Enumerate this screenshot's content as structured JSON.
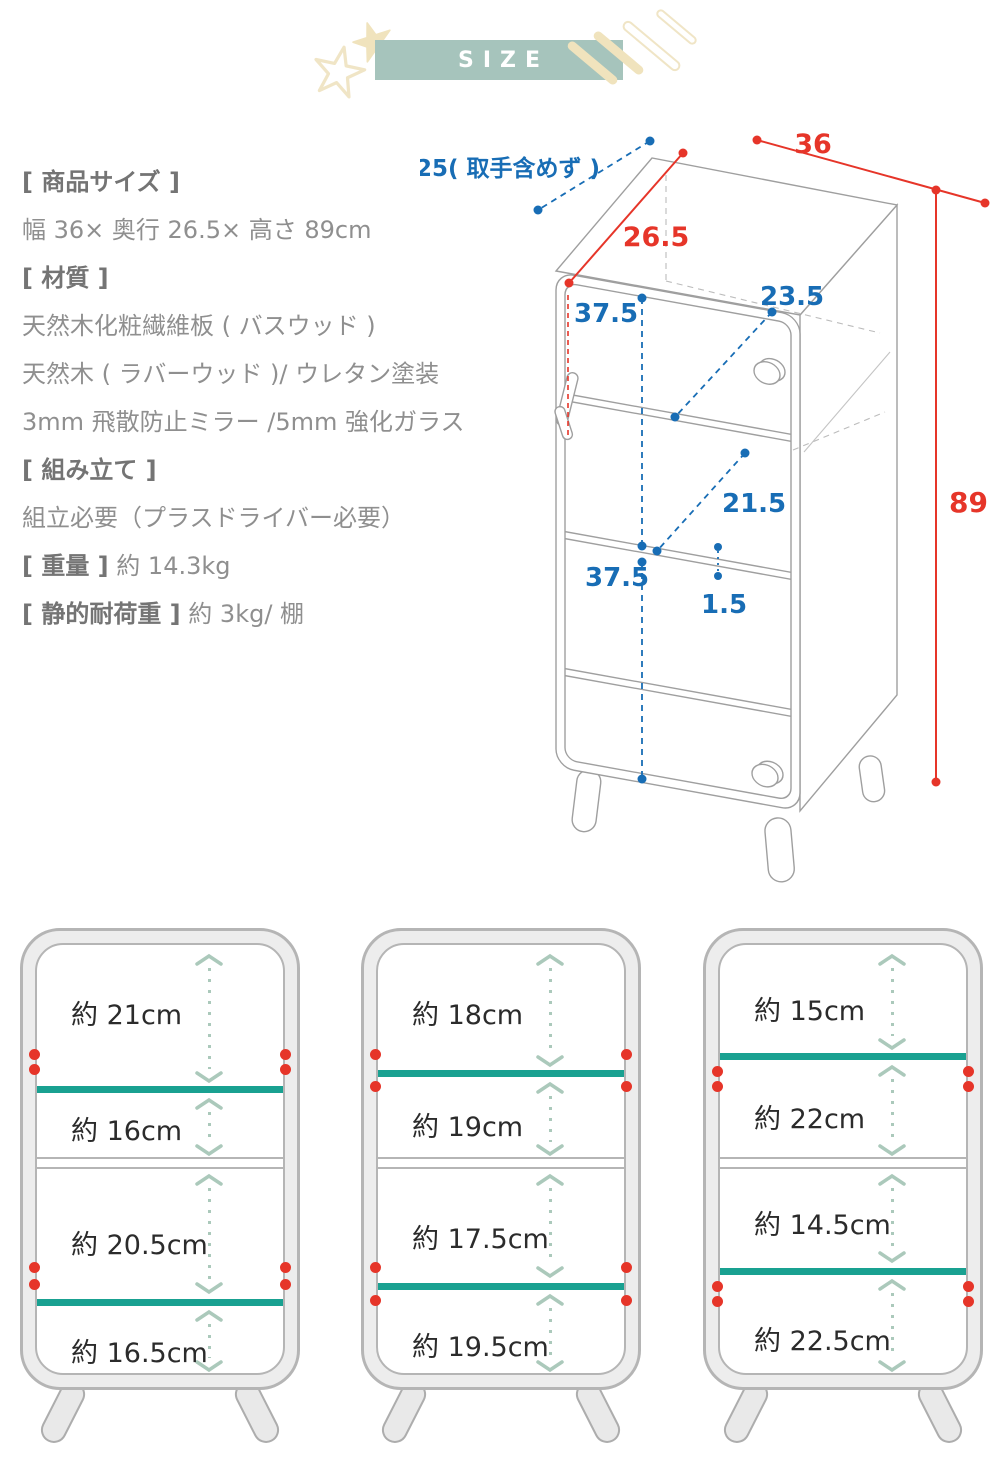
{
  "header": {
    "title": "SIZE"
  },
  "specs": {
    "size_heading": "[ 商品サイズ ]",
    "size_value": "幅 36× 奥行 26.5× 高さ 89cm",
    "material_heading": "[ 材質 ]",
    "material_1": "天然木化粧繊維板 ( バスウッド )",
    "material_2": "天然木 ( ラバーウッド )/ ウレタン塗装",
    "material_3": "3mm 飛散防止ミラー /5mm 強化ガラス",
    "assembly_heading": "[ 組み立て ]",
    "assembly_value": "組立必要（プラスドライバー必要）",
    "weight_heading": "[ 重量 ]",
    "weight_value": "約 14.3kg",
    "load_heading": "[ 静的耐荷重 ]",
    "load_value": "約 3kg/ 棚"
  },
  "diagram": {
    "depth_top_note": "25( 取手含めず )",
    "width_cm": "36",
    "depth_cm": "26.5",
    "height_cm": "89",
    "upper_inner_height_cm": "37.5",
    "top_shelf_depth_cm": "23.5",
    "middle_shelf_depth_cm": "21.5",
    "lower_inner_height_cm": "37.5",
    "shelf_thickness_cm": "1.5"
  },
  "panels": [
    {
      "sections": [
        "約 21cm",
        "約 16cm",
        "約 20.5cm",
        "約 16.5cm"
      ],
      "shelf_position": "low"
    },
    {
      "sections": [
        "約 18cm",
        "約 19cm",
        "約 17.5cm",
        "約 19.5cm"
      ],
      "shelf_position": "middle"
    },
    {
      "sections": [
        "約 15cm",
        "約 22cm",
        "約 14.5cm",
        "約 22.5cm"
      ],
      "shelf_position": "high"
    }
  ],
  "colors": {
    "banner_green": "#a6c4bc",
    "deco_cream": "#f0e3bd",
    "dimension_red": "#e63529",
    "dimension_blue": "#186db5",
    "movable_shelf_teal": "#19a191",
    "arrow_sage": "#abc9bb",
    "pin_dot_red": "#e63529"
  }
}
